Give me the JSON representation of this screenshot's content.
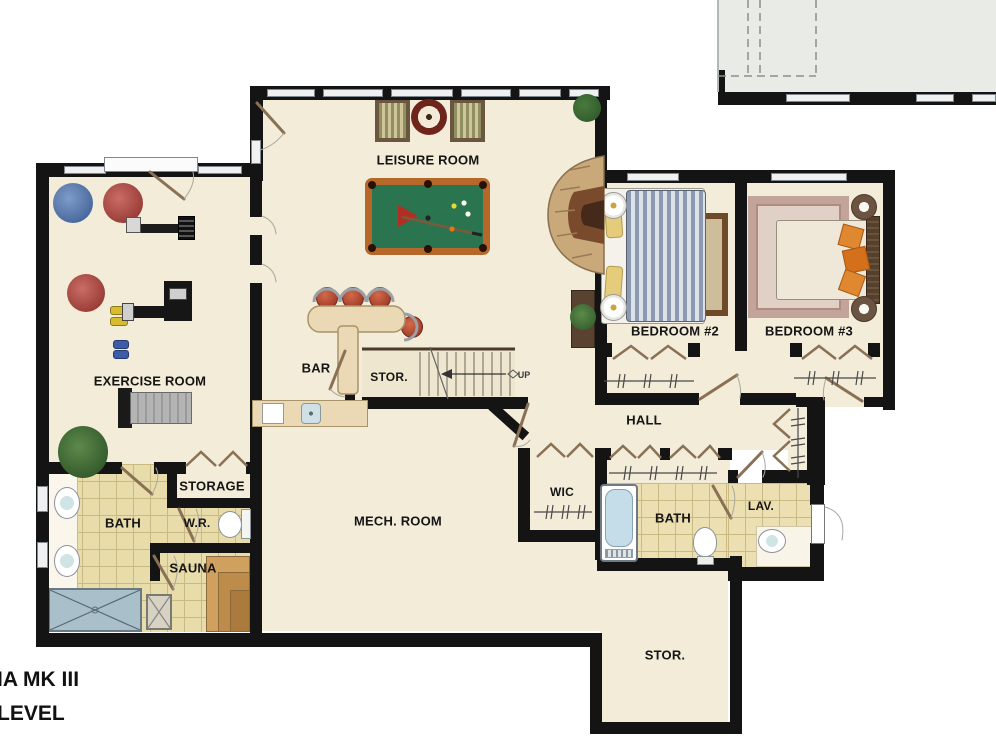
{
  "title": {
    "line1": "IA MK III",
    "line2": "LEVEL"
  },
  "rooms": {
    "leisure": "LEISURE ROOM",
    "exercise": "EXERCISE ROOM",
    "bar": "BAR",
    "stair_stor": "STOR.",
    "bedroom2": "BEDROOM #2",
    "bedroom3": "BEDROOM #3",
    "hall": "HALL",
    "storage": "STORAGE",
    "bath_left": "BATH",
    "wr": "W.R.",
    "sauna": "SAUNA",
    "wic": "WIC",
    "bath_right": "BATH",
    "lav": "LAV.",
    "mech": "MECH. ROOM",
    "stor_bottom": "STOR."
  },
  "stairs": {
    "direction_label": "UP"
  },
  "colors": {
    "wall": "#141414",
    "floor": "#f2ecd9",
    "tile": "#e8dcab",
    "pool_felt": "#2a7450",
    "pool_rail": "#b5682a",
    "garage_area": "#e9ebe6",
    "shower": "#a9c0cb",
    "sauna_bench": "#cfa05e",
    "door_leaf": "#8a7055"
  },
  "furniture": [
    "pool-table",
    "billiard-cue",
    "armchairs",
    "side-table",
    "stone-fireplace",
    "bar-counter",
    "bar-stools",
    "bar-sink",
    "exercise-balls",
    "weight-machine",
    "multi-gym",
    "treadmill",
    "dumbbells",
    "plants",
    "double-bed-blue",
    "double-bed-cream",
    "nightstands",
    "area-rugs",
    "bathtub",
    "toilets",
    "sinks",
    "shower",
    "sauna-benches",
    "floor-drain",
    "staircase"
  ]
}
